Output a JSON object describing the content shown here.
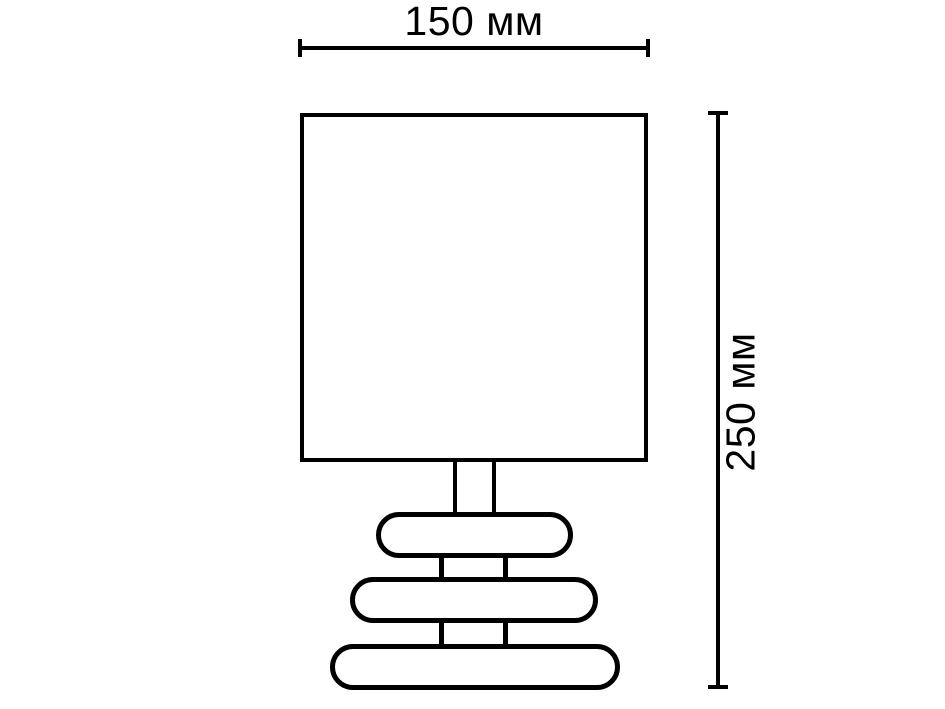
{
  "figure": {
    "type": "technical-dimension-drawing",
    "subject": "table lamp with square shade and three stacked pebble base"
  },
  "colors": {
    "background": "#ffffff",
    "line": "#000000"
  },
  "annotations": {
    "width_dimension": {
      "label": "150 мм",
      "value": 150,
      "unit": "мм",
      "orientation": "horizontal"
    },
    "height_dimension": {
      "label": "250 мм",
      "value": 250,
      "unit": "мм",
      "orientation": "vertical"
    }
  }
}
